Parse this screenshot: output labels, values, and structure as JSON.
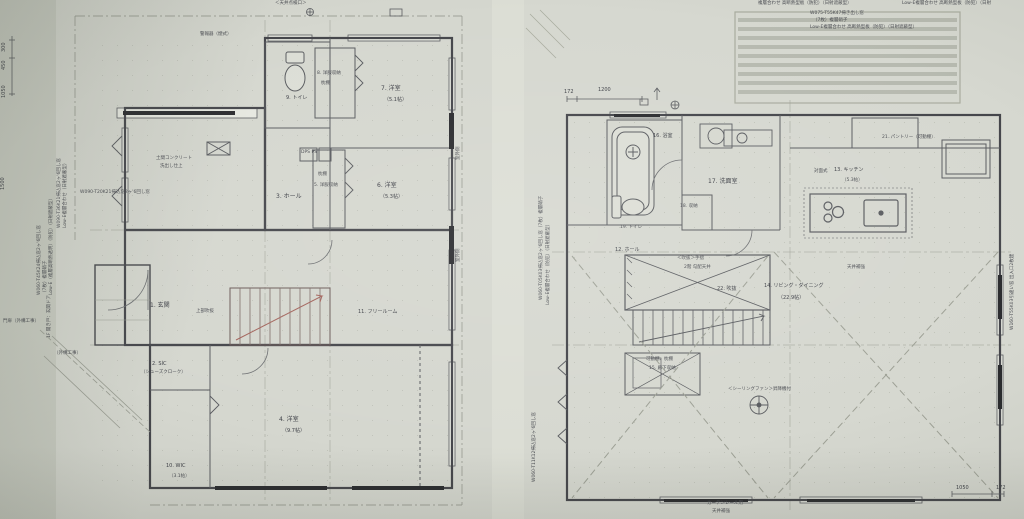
{
  "colors": {
    "paper": "#d5d7cf",
    "background": "#c9ccc2",
    "ink": "#46474c",
    "wall": "#2c2d30",
    "accent_red": "#a3645c"
  },
  "left_plan": {
    "rooms": {
      "genkan": "1. 玄関",
      "sic": "2. SIC",
      "sic_sub": "（シューズクローク）",
      "hall": "3. ホール",
      "yoshitsu4": "4. 洋室",
      "yoshitsu4_size": "（9.7帖）",
      "closet5": "5. 洋服収納",
      "closet5_sub": "枕棚",
      "yoshitsu6": "6. 洋室",
      "yoshitsu6_size": "（5.3帖）",
      "yoshitsu7": "7. 洋室",
      "yoshitsu7_size": "（5.1帖）",
      "closet8": "8. 洋服収納",
      "closet8_sub": "枕棚",
      "toilet": "9. トイレ",
      "wic": "10. WIC",
      "wic_size": "（3.1帖）",
      "free_room": "11. フリールーム"
    },
    "annotations": {
      "dps": "DPS PS",
      "void_above": "上部吹抜",
      "doma1": "土間コンクリート",
      "doma2": "洗出し仕上",
      "alarm": "警報器（煙式）",
      "ceiling_access": "＜天井点検口＞",
      "gaikou": "（外構工事）",
      "door_note": "1F 開き戸：玄関ドア",
      "gate": "門扉（外構工事）",
      "win_spec1a": "W060-T45K24掃込窓2ヶ'6回し窓",
      "win_spec1b": "（7枚）複層硝子",
      "win_spec1c": "Low-E（複層高断熱透明）（防犯）（日射遮蔽型）",
      "win_spec2a": "W090-T36K21掃込窓2ヶ'6回し窓",
      "win_spec2b": "Low-E複層合わせ（日射遮蔽型）",
      "win_spec3": "W090-T20K21掃込窓2ヶ'6回し窓",
      "outside_a": "室外側",
      "outside_b": "室外側"
    },
    "dimensions": {
      "d300": "300",
      "d450": "450",
      "d1050": "1050",
      "d1500": "1500"
    }
  },
  "right_plan": {
    "rooms": {
      "hall": "12. ホール",
      "kitchen_type": "対面式",
      "kitchen": "13. キッチン",
      "kitchen_size": "（5.3帖）",
      "living": "14. リビング・ダイニング",
      "living_size": "（22.9帖）",
      "closet15": "15. 廊下収納",
      "closet15_sub": "可動棚、枕棚",
      "bath": "16. 浴室",
      "washroom": "17. 洗面室",
      "storage18": "18. 収納",
      "toilet": "19. トイレ",
      "pantry": "21. パントリー（可動棚）",
      "void": "22. 吹抜"
    },
    "annotations": {
      "handrail": "＜吹抜＞手摺",
      "sloped_ceiling": "2階 勾配天井",
      "ceiling_reinforce": "天井補強",
      "fan": "＜シーリングファン＞昇降機付",
      "curtain1": "カーテンレール用",
      "curtain2": "天井補強",
      "spec_top1": "複層合わせ 高断熱型板（防犯）（日射遮蔽型）",
      "spec_top2": "Low-E複層合わせ 高断熱型板（防犯）（日射",
      "specblk1": "W075-T55K47掃き出し窓",
      "specblk2": "（7枚）複層硝子",
      "specblk3": "Low-E複層合わせ 高断熱型板（防犯）（日射遮蔽型）",
      "right_spec": "W160-T55K03引違い窓 出入口2枚建",
      "left_spec1": "W060-T05K03掃込窓2ヶ'6回し窓（7枚）複層硝子",
      "left_spec2": "Low-E複層合わせ（防犯）（日射遮蔽型）",
      "left_spec3": "W060-T11K12掃込窓2ヶ'6回し窓"
    },
    "dimensions": {
      "d172": "172",
      "d1200": "1200",
      "d1050": "1050",
      "d172b": "172"
    }
  }
}
